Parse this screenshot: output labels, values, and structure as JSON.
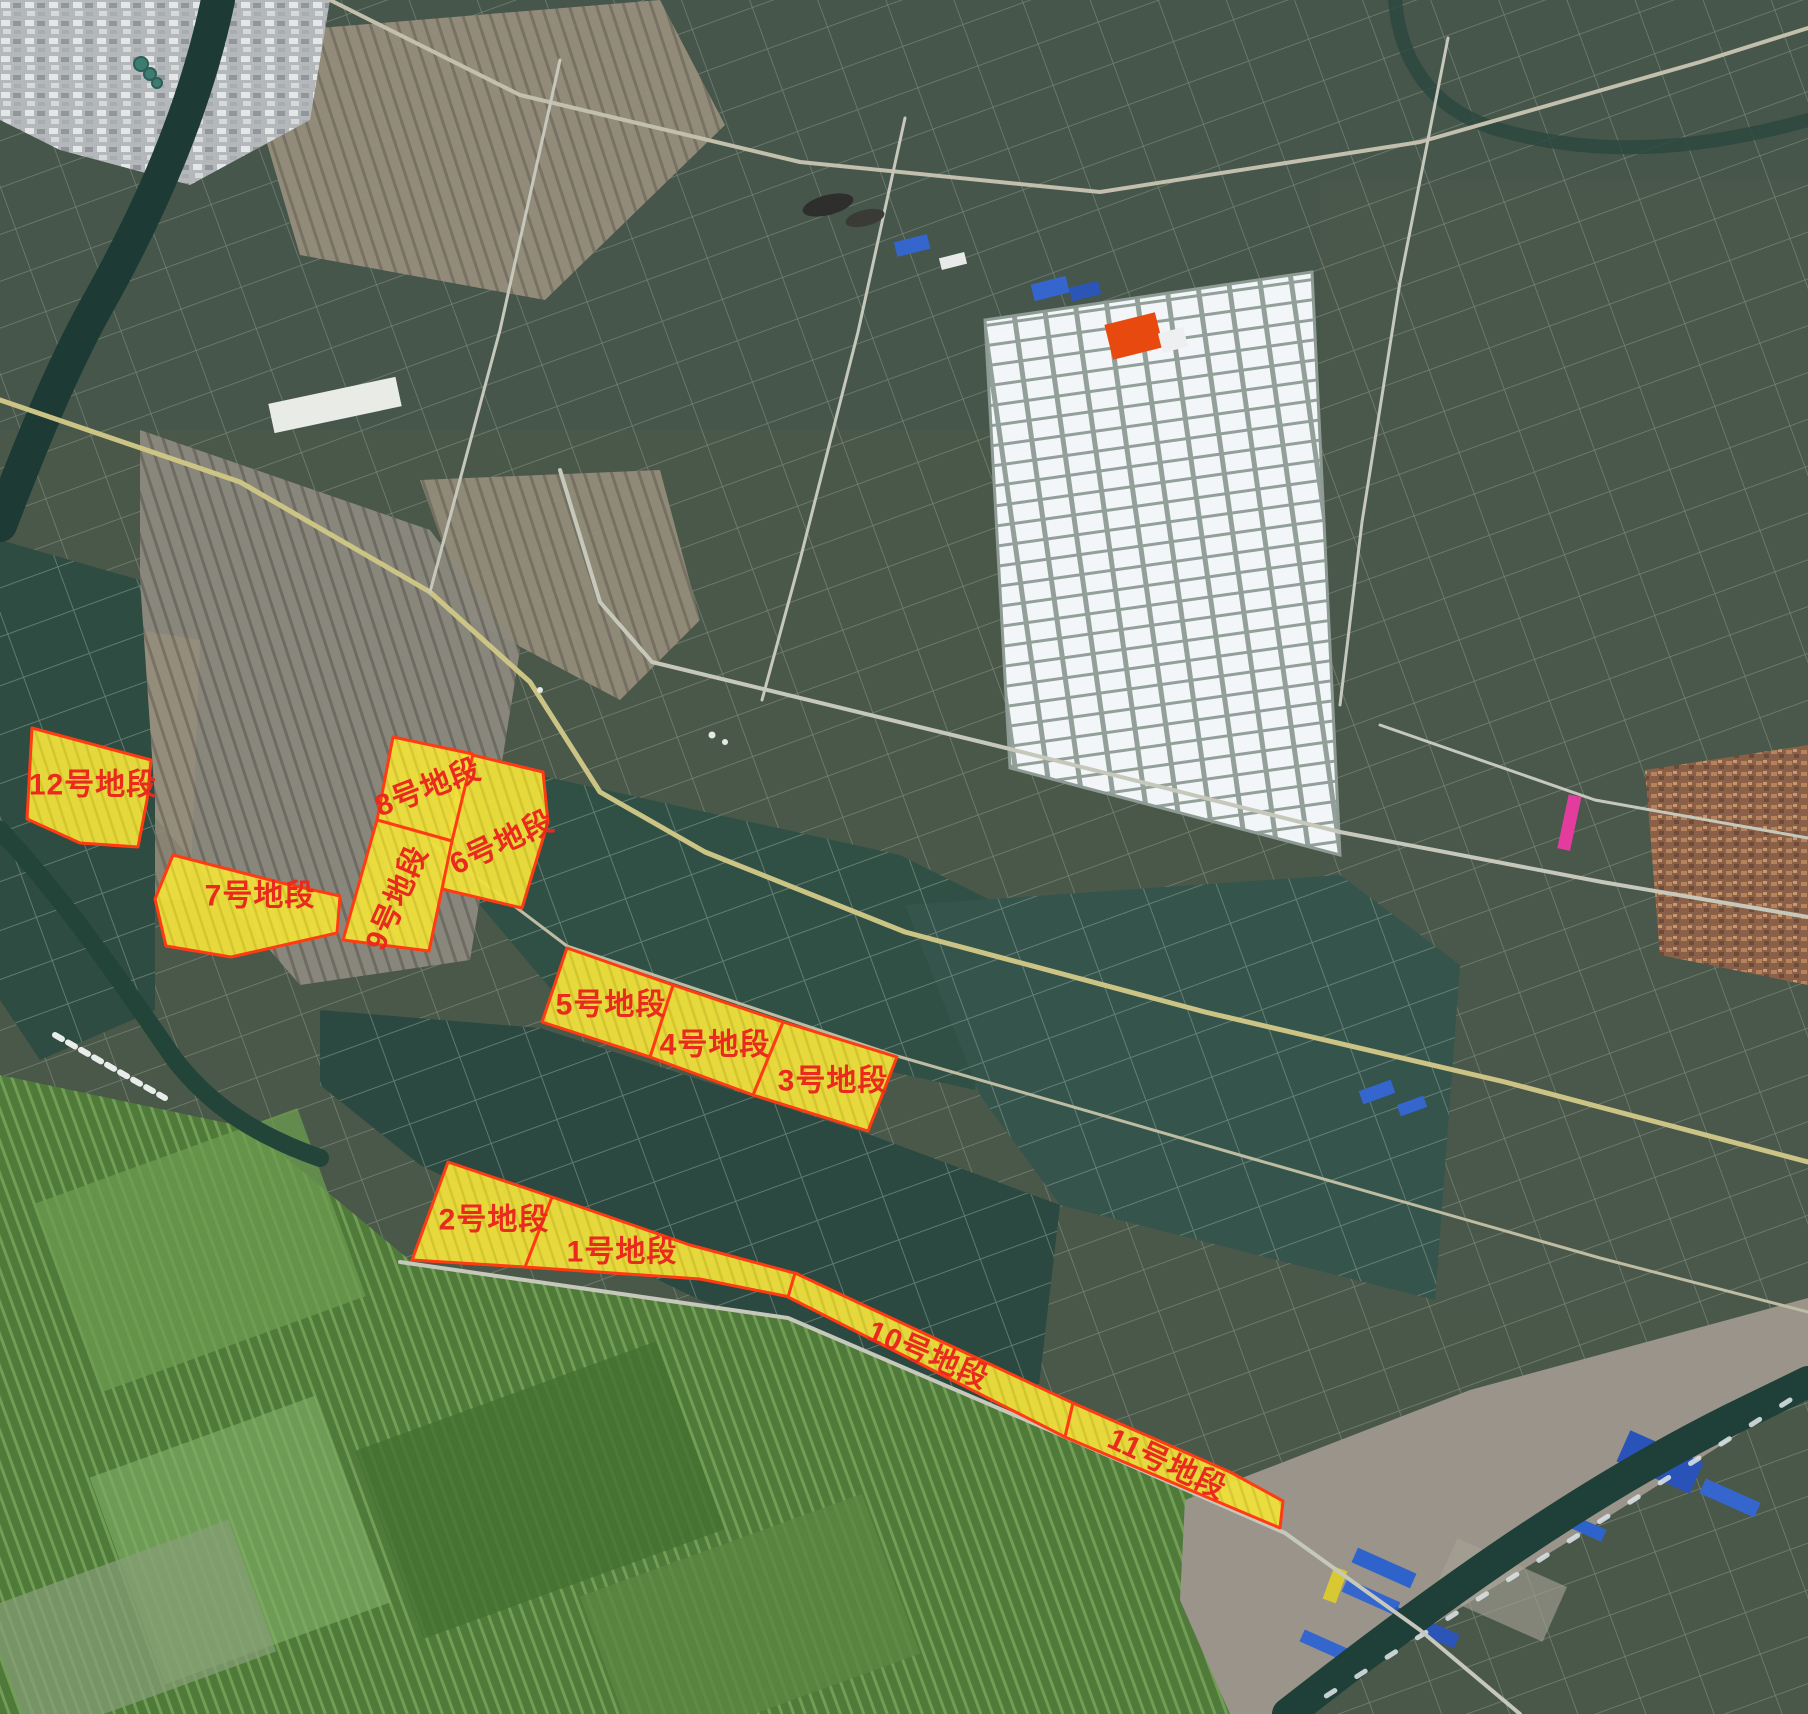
{
  "map": {
    "colors": {
      "parcel_fill": "#EFE03C",
      "parcel_fill_lines": "#DBCB2D",
      "parcel_border": "#FF3B14",
      "label_color": "#E92A1C"
    },
    "parcels": [
      {
        "id": 1,
        "label": "1号地段",
        "label_x": 622,
        "label_y": 1252,
        "label_rotation": 0,
        "polygon": [
          [
            552,
            1197
          ],
          [
            690,
            1245
          ],
          [
            798,
            1274
          ],
          [
            790,
            1297
          ],
          [
            700,
            1279
          ],
          [
            525,
            1267
          ]
        ]
      },
      {
        "id": 2,
        "label": "2号地段",
        "label_x": 494,
        "label_y": 1220,
        "label_rotation": 0,
        "polygon": [
          [
            448,
            1162
          ],
          [
            552,
            1197
          ],
          [
            525,
            1267
          ],
          [
            412,
            1260
          ]
        ]
      },
      {
        "id": 3,
        "label": "3号地段",
        "label_x": 833,
        "label_y": 1081,
        "label_rotation": 0,
        "polygon": [
          [
            783,
            1022
          ],
          [
            897,
            1057
          ],
          [
            868,
            1131
          ],
          [
            753,
            1095
          ]
        ]
      },
      {
        "id": 4,
        "label": "4号地段",
        "label_x": 715,
        "label_y": 1045,
        "label_rotation": 0,
        "polygon": [
          [
            673,
            985
          ],
          [
            783,
            1022
          ],
          [
            753,
            1095
          ],
          [
            650,
            1057
          ]
        ]
      },
      {
        "id": 5,
        "label": "5号地段",
        "label_x": 611,
        "label_y": 1005,
        "label_rotation": 0,
        "polygon": [
          [
            567,
            948
          ],
          [
            673,
            985
          ],
          [
            650,
            1057
          ],
          [
            542,
            1022
          ]
        ]
      },
      {
        "id": 6,
        "label": "6号地段",
        "label_x": 502,
        "label_y": 843,
        "label_rotation": -25,
        "polygon": [
          [
            460,
            752
          ],
          [
            543,
            772
          ],
          [
            548,
            822
          ],
          [
            522,
            908
          ],
          [
            438,
            888
          ]
        ]
      },
      {
        "id": 7,
        "label": "7号地段",
        "label_x": 260,
        "label_y": 896,
        "label_rotation": 0,
        "polygon": [
          [
            173,
            855
          ],
          [
            282,
            883
          ],
          [
            340,
            896
          ],
          [
            337,
            933
          ],
          [
            231,
            957
          ],
          [
            166,
            946
          ],
          [
            155,
            899
          ]
        ]
      },
      {
        "id": 8,
        "label": "8号地段",
        "label_x": 428,
        "label_y": 788,
        "label_rotation": -21,
        "polygon": [
          [
            393,
            737
          ],
          [
            473,
            754
          ],
          [
            452,
            841
          ],
          [
            377,
            820
          ]
        ]
      },
      {
        "id": 9,
        "label": "9号地段",
        "label_x": 397,
        "label_y": 898,
        "label_rotation": -66,
        "polygon": [
          [
            377,
            820
          ],
          [
            452,
            841
          ],
          [
            429,
            951
          ],
          [
            343,
            940
          ]
        ]
      },
      {
        "id": 10,
        "label": "10号地段",
        "label_x": 928,
        "label_y": 1355,
        "label_rotation": 23,
        "polygon": [
          [
            795,
            1273
          ],
          [
            1073,
            1403
          ],
          [
            1065,
            1437
          ],
          [
            788,
            1297
          ]
        ]
      },
      {
        "id": 11,
        "label": "11号地段",
        "label_x": 1167,
        "label_y": 1464,
        "label_rotation": 25,
        "polygon": [
          [
            1073,
            1403
          ],
          [
            1230,
            1472
          ],
          [
            1283,
            1501
          ],
          [
            1280,
            1528
          ],
          [
            1190,
            1490
          ],
          [
            1065,
            1437
          ]
        ]
      },
      {
        "id": 12,
        "label": "12号地段",
        "label_x": 93,
        "label_y": 785,
        "label_rotation": 0,
        "polygon": [
          [
            32,
            728
          ],
          [
            151,
            760
          ],
          [
            147,
            800
          ],
          [
            138,
            847
          ],
          [
            80,
            843
          ],
          [
            27,
            819
          ]
        ]
      }
    ]
  }
}
